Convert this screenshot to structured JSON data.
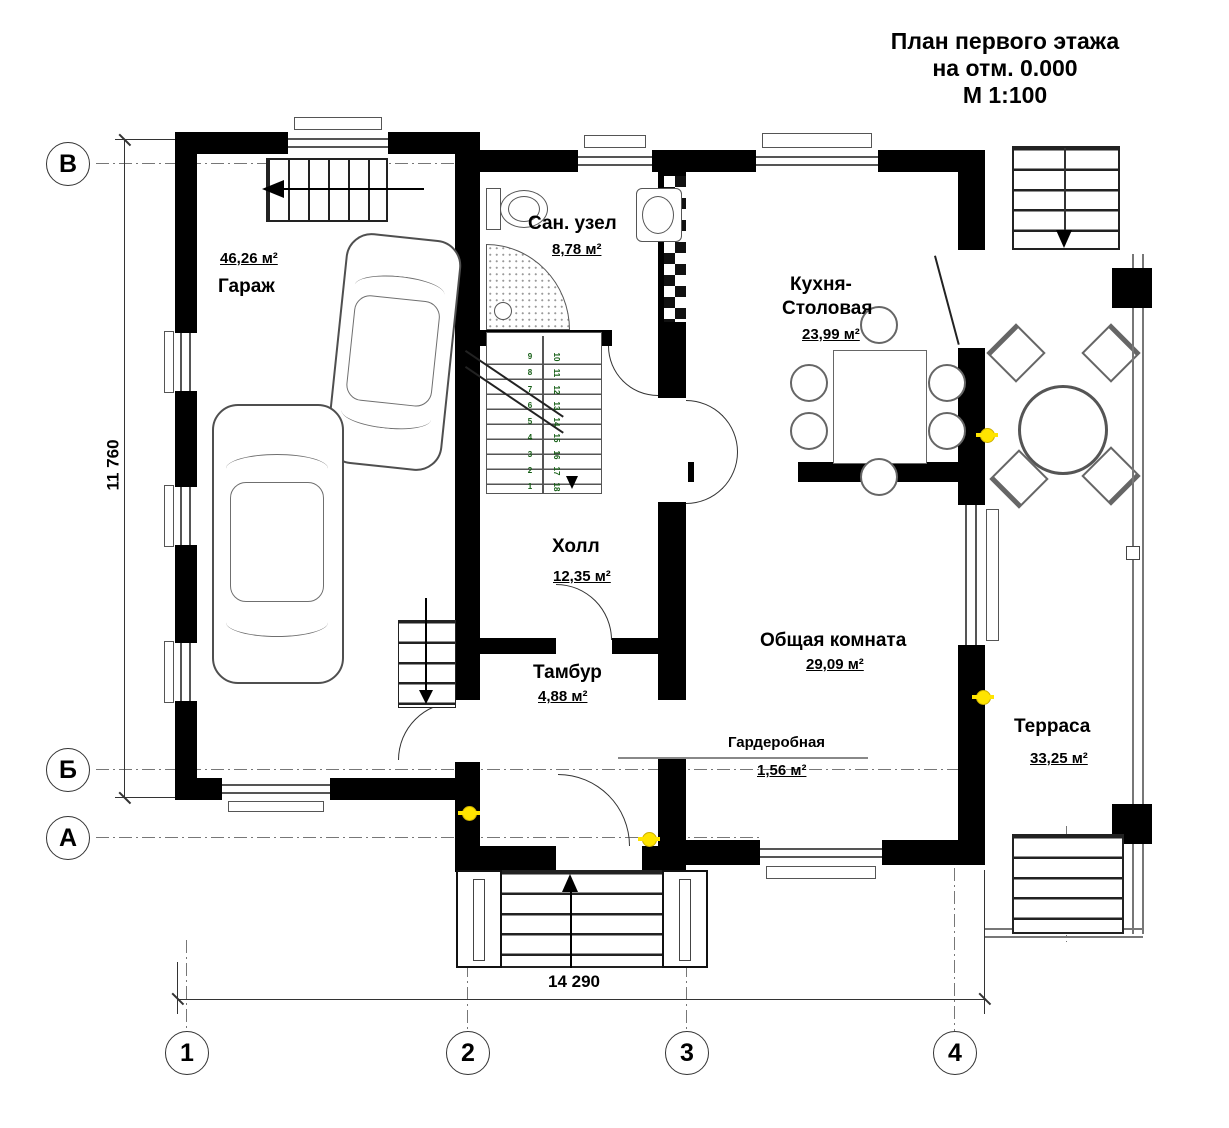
{
  "title": {
    "line1": "План первого этажа",
    "line2": "на отм. 0.000",
    "line3": "М 1:100"
  },
  "rooms": {
    "garage": {
      "name": "Гараж",
      "area": "46,26 м²"
    },
    "sanuzel": {
      "name": "Сан. узел",
      "area": "8,78 м²"
    },
    "kitchen": {
      "name1": "Кухня-",
      "name2": "Столовая",
      "area": "23,99 м²"
    },
    "hall": {
      "name": "Холл",
      "area": "12,35 м²"
    },
    "tambour": {
      "name": "Тамбур",
      "area": "4,88 м²"
    },
    "living": {
      "name": "Общая комната",
      "area": "29,09 м²"
    },
    "wardrobe": {
      "name": "Гардеробная",
      "area": "1,56 м²"
    },
    "terrace": {
      "name": "Терраса",
      "area": "33,25 м²"
    }
  },
  "axes": {
    "row_top": "В",
    "row_mid": "Б",
    "row_bottom": "А",
    "col1": "1",
    "col2": "2",
    "col3": "3",
    "col4": "4"
  },
  "dimensions": {
    "horizontal": "14 290",
    "vertical": "11 760"
  },
  "stairs": {
    "left": [
      "9",
      "8",
      "7",
      "6",
      "5",
      "4",
      "3",
      "2",
      "1"
    ],
    "right": [
      "10",
      "11",
      "12",
      "13",
      "14",
      "15",
      "16",
      "17",
      "18"
    ]
  },
  "colors": {
    "wall": "#000000",
    "line": "#555555",
    "light_accent": "#ffe400",
    "stair_number": "#155e15"
  }
}
